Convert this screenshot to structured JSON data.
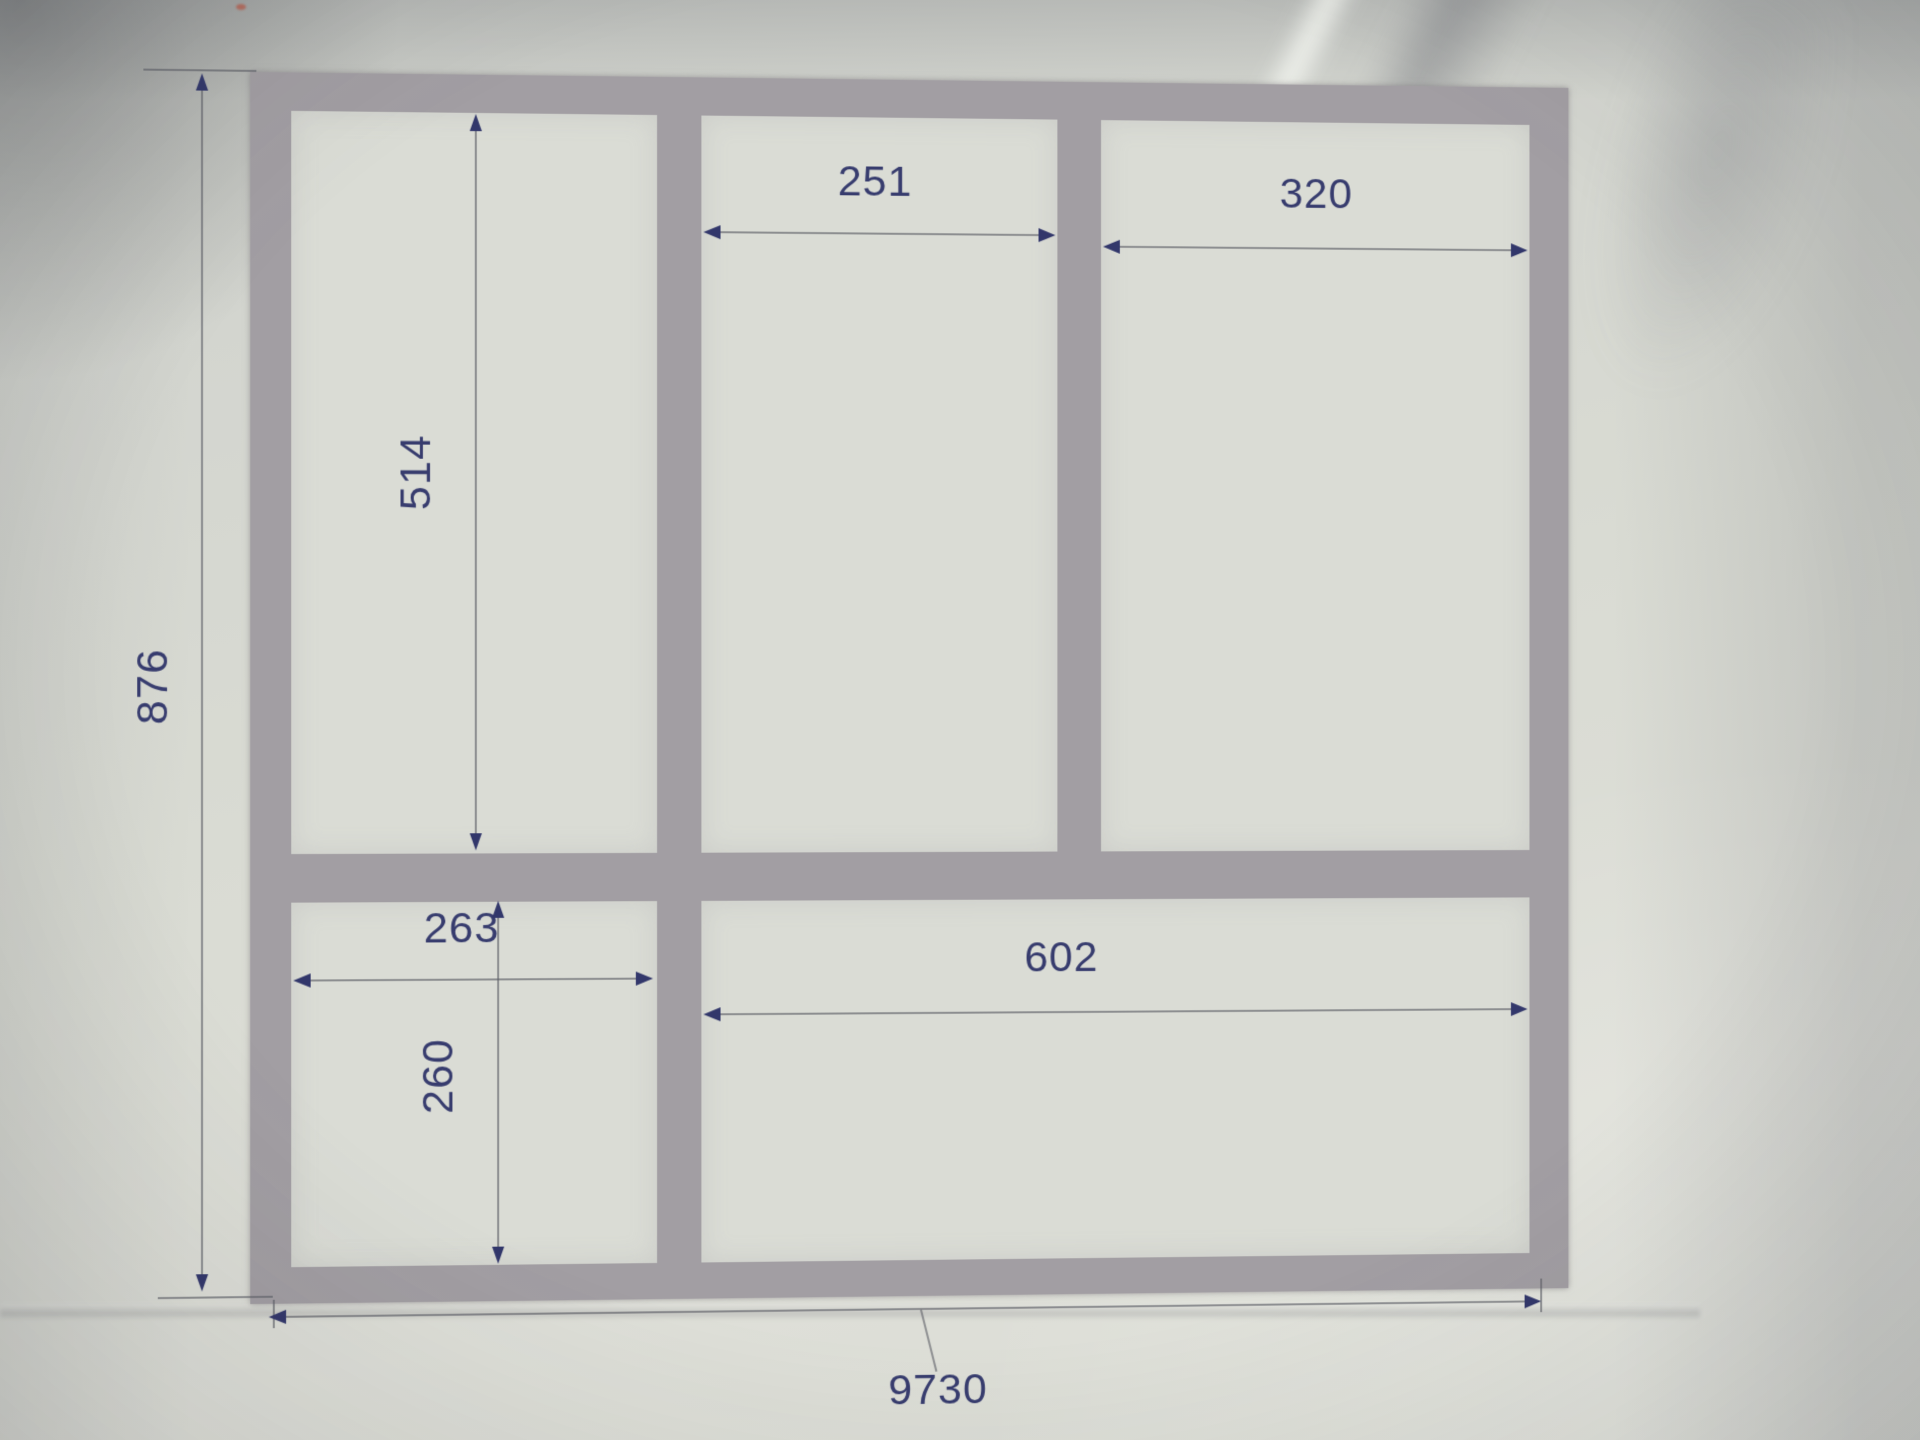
{
  "drawing": {
    "kind": "frame-elevation-sketch",
    "dims": {
      "overall_height": {
        "value": "876",
        "orientation": "vertical"
      },
      "upper_left_height": {
        "value": "514",
        "orientation": "vertical"
      },
      "lower_left_width": {
        "value": "263",
        "orientation": "horizontal"
      },
      "lower_left_height": {
        "value": "260",
        "orientation": "vertical"
      },
      "upper_middle_width": {
        "value": "251",
        "orientation": "horizontal"
      },
      "upper_right_width": {
        "value": "320",
        "orientation": "horizontal"
      },
      "lower_right_width": {
        "value": "602",
        "orientation": "horizontal"
      },
      "overall_width": {
        "value": "9730",
        "orientation": "horizontal"
      }
    },
    "colors": {
      "paper": "#d9dbd3",
      "frame_member": "#a29ea3",
      "cell_fill": "#dadcd5",
      "annotation_text": "#373c6e",
      "dimension_line": "#5c5e66"
    }
  }
}
